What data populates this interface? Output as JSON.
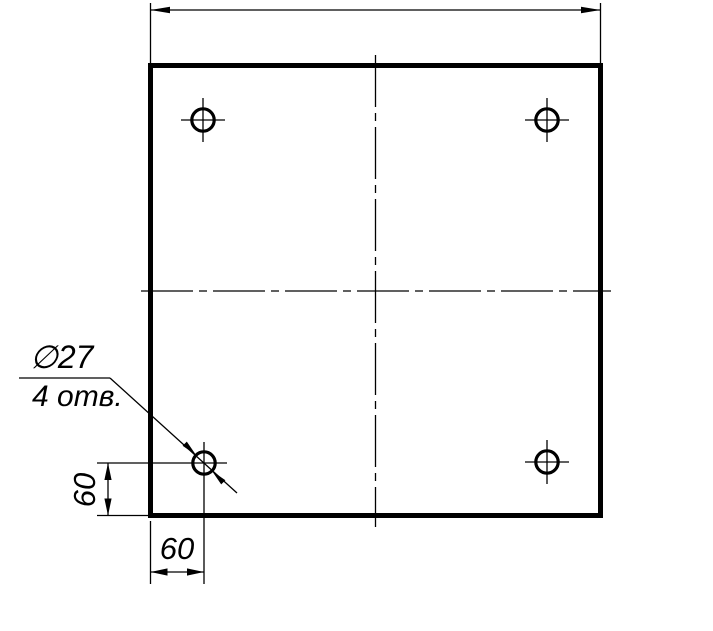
{
  "drawing": {
    "type": "engineering-drawing",
    "description": "Square plate with four drilled holes, orthographic front view",
    "colors": {
      "line": "#000000",
      "background": "#ffffff"
    },
    "labels": {
      "hole_diameter": "∅27",
      "hole_count": "4 отв.",
      "dim_left": "60",
      "dim_bottom": "60"
    }
  }
}
